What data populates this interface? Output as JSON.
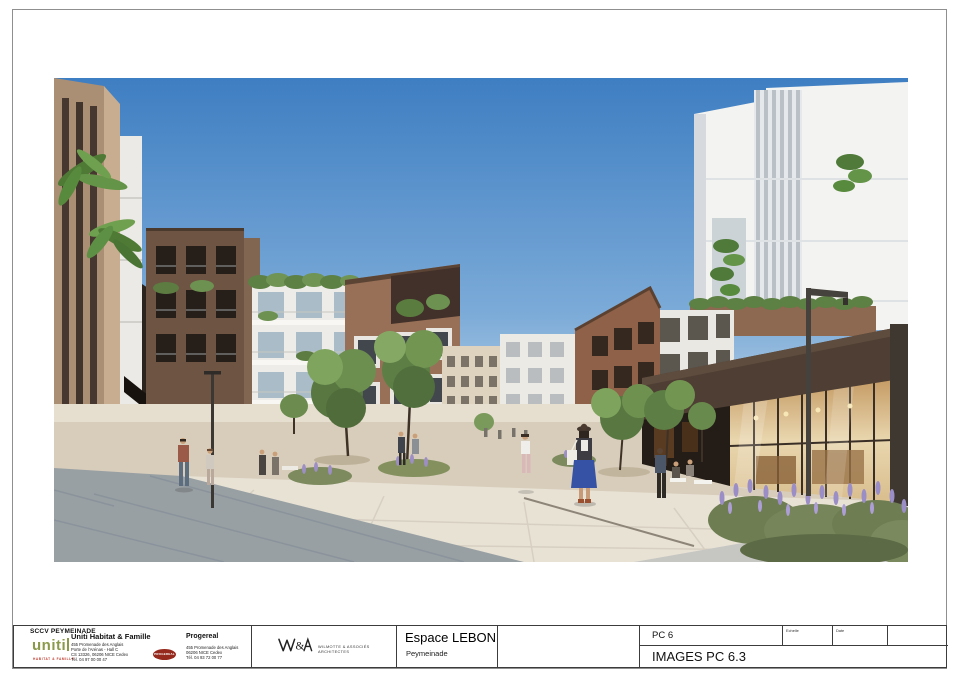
{
  "sheet": {
    "code": "PC 6",
    "title": "IMAGES PC 6.3",
    "scale_label": "Echelle",
    "date_label": "Date"
  },
  "project": {
    "name": "Espace LEBON",
    "location": "Peymeinade"
  },
  "client": {
    "company": "SCCV PEYMEINADE",
    "uniti": {
      "logo": "uniti",
      "tagline": "HABITAT & FAMILLE",
      "name": "Uniti Habitat & Famille",
      "address": [
        "455 Promenade des Anglais",
        "Porte de l'Arénas - Hall C",
        "CS 13326, 06206 NICE Cedex",
        "Tél. 04 97 00 00 47"
      ]
    },
    "progereal": {
      "logo": "PROGEREAL",
      "name": "Progereal",
      "address": [
        "455 Promenade des Anglais",
        "06206 NICE Cedex",
        "Tél. 04 93 72 00 77"
      ]
    }
  },
  "architect": {
    "logo": "W&A",
    "name": "WILMOTTE & ASSOCIÉS ARCHITECTES"
  },
  "colors": {
    "uniti_green": "#8a9a48",
    "progereal_red": "#96291d",
    "border_gray": "#8f8f8f",
    "titleblock_line": "#3c3c3c",
    "sky_top": "#3e7ec2",
    "sky_horizon": "#dce8f0",
    "brick_warm": "#977057",
    "brick_dark": "#6e5443",
    "facade_white": "#f3f3f1",
    "storefront_glow": "#e9d6ae",
    "pavilion_brown": "#4e3e33",
    "ground_beige": "#d8cdbb",
    "ground_pale": "#e8e2d5",
    "ground_gray": "#99a0a3",
    "foliage_green": "#5d7f45",
    "lavender_purple": "#9d8fc4"
  }
}
